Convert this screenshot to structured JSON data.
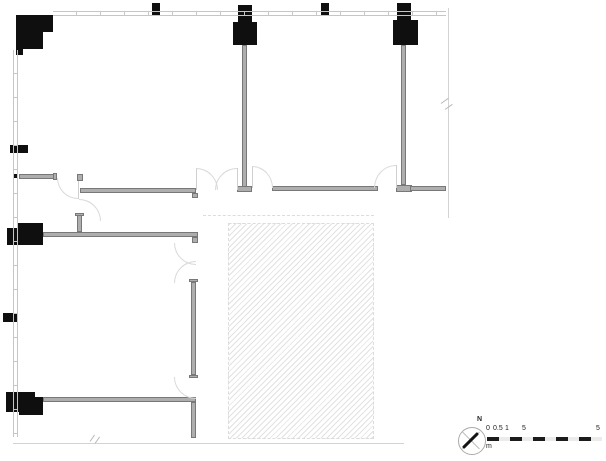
{
  "colors": {
    "column": "#0f0f0f",
    "wall_fill": "#aeaeae",
    "wall_edge": "#787878",
    "thin_line": "#c6c6c6",
    "leaf": "#cfcfcf",
    "arc": "#d9d9d9",
    "hatch_line": "#e2e2e2",
    "hatch_border": "#dcdcdc",
    "boundary": "#d3d3d3",
    "break_mark": "#b9b9b9",
    "scale_dark": "#1c1c1c",
    "scale_light": "#ebebeb"
  },
  "compass": {
    "north_label": "N"
  },
  "scale_bar": {
    "labels": [
      "0",
      "0.5",
      "1",
      "5",
      "5"
    ],
    "unit": "m",
    "segments": [
      {
        "x": 487,
        "w": 12,
        "shade": "dark"
      },
      {
        "x": 499,
        "w": 11,
        "shade": "light"
      },
      {
        "x": 510,
        "w": 12,
        "shade": "dark"
      },
      {
        "x": 522,
        "w": 11,
        "shade": "light"
      },
      {
        "x": 533,
        "w": 12,
        "shade": "dark"
      },
      {
        "x": 545,
        "w": 11,
        "shade": "light"
      },
      {
        "x": 556,
        "w": 12,
        "shade": "dark"
      },
      {
        "x": 568,
        "w": 11,
        "shade": "light"
      },
      {
        "x": 579,
        "w": 12,
        "shade": "dark"
      },
      {
        "x": 591,
        "w": 11,
        "shade": "light"
      }
    ]
  },
  "plan": {
    "columns": [
      {
        "name": "column-top-left-a",
        "x": 16,
        "y": 15,
        "w": 37,
        "h": 17
      },
      {
        "name": "column-top-left-b",
        "x": 16,
        "y": 32,
        "w": 27,
        "h": 17
      },
      {
        "name": "column-top-left-c",
        "x": 16,
        "y": 49,
        "w": 7,
        "h": 6
      },
      {
        "name": "column-stub-top-1",
        "x": 152,
        "y": 3,
        "w": 8,
        "h": 12
      },
      {
        "name": "column-mid-top-neck",
        "x": 238,
        "y": 5,
        "w": 14,
        "h": 17
      },
      {
        "name": "column-mid-top-body",
        "x": 233,
        "y": 22,
        "w": 24,
        "h": 23
      },
      {
        "name": "column-stub-top-2",
        "x": 321,
        "y": 3,
        "w": 8,
        "h": 13
      },
      {
        "name": "column-right-top-neck",
        "x": 397,
        "y": 3,
        "w": 14,
        "h": 17
      },
      {
        "name": "column-right-top-body",
        "x": 393,
        "y": 20,
        "w": 25,
        "h": 25
      },
      {
        "name": "column-left-small-1",
        "x": 10,
        "y": 145,
        "w": 18,
        "h": 8
      },
      {
        "name": "column-left-tick",
        "x": 13,
        "y": 174,
        "w": 5,
        "h": 4
      },
      {
        "name": "column-left-mid-a",
        "x": 18,
        "y": 223,
        "w": 25,
        "h": 12
      },
      {
        "name": "column-left-mid-b",
        "x": 7,
        "y": 228,
        "w": 36,
        "h": 17
      },
      {
        "name": "column-left-small-2",
        "x": 3,
        "y": 313,
        "w": 14,
        "h": 9
      },
      {
        "name": "column-left-bottom-a",
        "x": 6,
        "y": 392,
        "w": 29,
        "h": 20
      },
      {
        "name": "column-left-bottom-b",
        "x": 19,
        "y": 397,
        "w": 24,
        "h": 18
      }
    ],
    "walls": [
      {
        "name": "wall-mid-column",
        "x": 242,
        "y": 45,
        "w": 5,
        "h": 142
      },
      {
        "name": "wall-mid-column-foot",
        "x": 237,
        "y": 186,
        "w": 15,
        "h": 6
      },
      {
        "name": "wall-right-column",
        "x": 401,
        "y": 45,
        "w": 5,
        "h": 140
      },
      {
        "name": "wall-right-column-foot",
        "x": 396,
        "y": 185,
        "w": 16,
        "h": 7
      },
      {
        "name": "wall-center-room-bottom",
        "x": 272,
        "y": 186,
        "w": 106,
        "h": 5
      },
      {
        "name": "wall-right-room-bottom",
        "x": 410,
        "y": 186,
        "w": 36,
        "h": 5
      },
      {
        "name": "wall-vestibule-stub",
        "x": 19,
        "y": 174,
        "w": 36,
        "h": 5
      },
      {
        "name": "wall-vestibule-stub-cap",
        "x": 53,
        "y": 173,
        "w": 4,
        "h": 7
      },
      {
        "name": "wall-vestibule-post",
        "x": 77,
        "y": 174,
        "w": 6,
        "h": 7
      },
      {
        "name": "wall-vestibule-bottom",
        "x": 80,
        "y": 188,
        "w": 116,
        "h": 5
      },
      {
        "name": "wall-vestibule-bottom-cap",
        "x": 192,
        "y": 193,
        "w": 6,
        "h": 5
      },
      {
        "name": "wall-room2-top",
        "x": 43,
        "y": 232,
        "w": 155,
        "h": 5
      },
      {
        "name": "wall-room2-top-cap",
        "x": 192,
        "y": 237,
        "w": 6,
        "h": 6
      },
      {
        "name": "wall-stub-above-room2",
        "x": 77,
        "y": 214,
        "w": 5,
        "h": 18
      },
      {
        "name": "wall-stub-above-room2-cap",
        "x": 75,
        "y": 213,
        "w": 9,
        "h": 3
      },
      {
        "name": "wall-room2-right",
        "x": 191,
        "y": 282,
        "w": 5,
        "h": 93
      },
      {
        "name": "wall-room2-right-cap-top",
        "x": 189,
        "y": 279,
        "w": 9,
        "h": 3
      },
      {
        "name": "wall-room2-right-cap-bottom",
        "x": 189,
        "y": 375,
        "w": 9,
        "h": 3
      },
      {
        "name": "wall-room3-top",
        "x": 43,
        "y": 397,
        "w": 153,
        "h": 5
      },
      {
        "name": "wall-room3-right",
        "x": 191,
        "y": 402,
        "w": 5,
        "h": 36
      }
    ],
    "thin_walls": [
      {
        "name": "curtain-wall-top",
        "dir": "h",
        "x": 53,
        "y": 11,
        "w": 393,
        "h": 5,
        "tick": 24
      },
      {
        "name": "curtain-wall-left",
        "dir": "v",
        "x": 13,
        "y": 50,
        "w": 5,
        "h": 387,
        "tick": 24
      }
    ],
    "boundary_lines": [
      {
        "name": "right-boundary-line",
        "x": 448,
        "y": 8,
        "w": 1,
        "h": 210
      },
      {
        "name": "bottom-boundary-line",
        "x": 13,
        "y": 443,
        "w": 391,
        "h": 1
      },
      {
        "name": "hatch-guide-line",
        "x": 203,
        "y": 215,
        "w": 171,
        "h": 0,
        "dashed": true
      }
    ],
    "leaf_lines": [
      {
        "name": "door-leaf-vestibule",
        "x": 78,
        "y": 181,
        "w": 1,
        "h": 18
      },
      {
        "name": "door-leaf-double-left",
        "x": 196,
        "y": 168,
        "w": 1,
        "h": 22
      },
      {
        "name": "door-leaf-double-right",
        "x": 237,
        "y": 168,
        "w": 1,
        "h": 22
      },
      {
        "name": "door-leaf-mid-east",
        "x": 252,
        "y": 166,
        "w": 1,
        "h": 22
      },
      {
        "name": "door-leaf-right-room",
        "x": 396,
        "y": 165,
        "w": 1,
        "h": 23
      }
    ],
    "door_arcs": [
      {
        "name": "door-arc-vestibule-1",
        "x": 57,
        "y": 178,
        "w": 21,
        "h": 21,
        "corner": "bl"
      },
      {
        "name": "door-arc-vestibule-2",
        "x": 79,
        "y": 199,
        "w": 22,
        "h": 22,
        "corner": "tr"
      },
      {
        "name": "door-arc-double-left",
        "x": 196,
        "y": 168,
        "w": 22,
        "h": 22,
        "corner": "tr"
      },
      {
        "name": "door-arc-double-right",
        "x": 215,
        "y": 168,
        "w": 22,
        "h": 22,
        "corner": "tl"
      },
      {
        "name": "door-arc-mid-east",
        "x": 252,
        "y": 166,
        "w": 21,
        "h": 22,
        "corner": "tr"
      },
      {
        "name": "door-arc-right-room",
        "x": 374,
        "y": 165,
        "w": 22,
        "h": 23,
        "corner": "tl"
      },
      {
        "name": "door-arc-swing-upper",
        "x": 174,
        "y": 243,
        "w": 22,
        "h": 22,
        "corner": "bl"
      },
      {
        "name": "door-arc-swing-lower",
        "x": 174,
        "y": 261,
        "w": 22,
        "h": 22,
        "corner": "tl"
      },
      {
        "name": "door-arc-room3",
        "x": 174,
        "y": 377,
        "w": 22,
        "h": 22,
        "corner": "bl"
      }
    ],
    "hatch_area": {
      "name": "hatched-zone",
      "x": 228,
      "y": 223,
      "w": 146,
      "h": 216
    },
    "break_marks": [
      {
        "name": "break-mark-right",
        "strokes": [
          {
            "x": 441,
            "y": 103,
            "len": 9,
            "rot": -35
          },
          {
            "x": 445,
            "y": 109,
            "len": 9,
            "rot": -35
          }
        ]
      },
      {
        "name": "break-mark-bottom",
        "strokes": [
          {
            "x": 90,
            "y": 441,
            "len": 8,
            "rot": -55
          },
          {
            "x": 95,
            "y": 443,
            "len": 8,
            "rot": -55
          }
        ]
      }
    ]
  }
}
